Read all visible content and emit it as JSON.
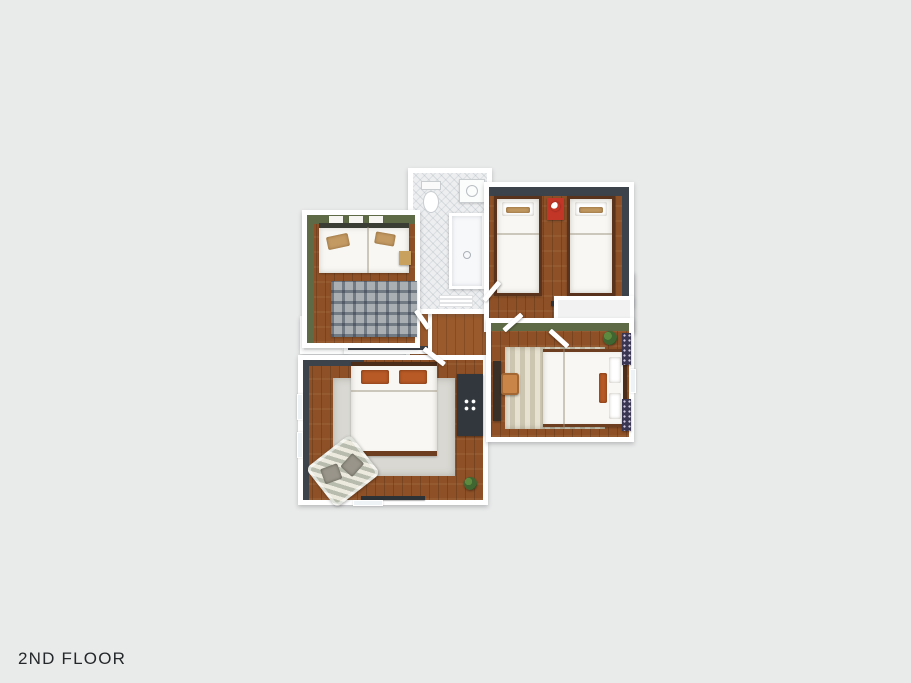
{
  "page": {
    "background_color": "#e9eaea",
    "floor_label": "2ND FLOOR"
  },
  "floorplan": {
    "type": "3d-rendered-top-down-floor-plan",
    "colors": {
      "exterior_wall": "#ffffff",
      "charcoal_wall": "#3d434a",
      "olive_green_wall": "#5e6a45",
      "wood_floor": "#8e5127",
      "tile_floor": "#eceef0",
      "bedding_white": "#f8f7f3",
      "accent_orange": "#b85a26",
      "accent_red": "#c23627",
      "rug_gray": "#d9d8d2",
      "plant_green": "#3f6631"
    },
    "rooms": [
      {
        "name": "guest-bedroom",
        "wall_accent": "olive-green",
        "furniture": [
          "daybed",
          "tan-pillows",
          "plaid-rug",
          "side-table",
          "wall-shelf-decor"
        ]
      },
      {
        "name": "bathroom",
        "furniture": [
          "toilet",
          "sink",
          "shower",
          "bath-mat"
        ]
      },
      {
        "name": "kids-bedroom",
        "wall_accent": "charcoal",
        "furniture": [
          "twin-bed-left",
          "twin-bed-right",
          "red-nightstand",
          "wall-shelf",
          "closet"
        ]
      },
      {
        "name": "master-bedroom",
        "wall_accent": "charcoal",
        "furniture": [
          "double-bed",
          "orange-pillows",
          "area-rug",
          "striped-armchair",
          "dresser",
          "wall-tv",
          "plant"
        ]
      },
      {
        "name": "bedroom-three",
        "wall_accent": "olive-green",
        "furniture": [
          "double-bed",
          "striped-rug",
          "desk",
          "desk-chair",
          "plant",
          "patterned-curtains"
        ]
      },
      {
        "name": "hallway",
        "furniture": [
          "staircase",
          "hall-closet",
          "linen-closet"
        ]
      }
    ]
  }
}
